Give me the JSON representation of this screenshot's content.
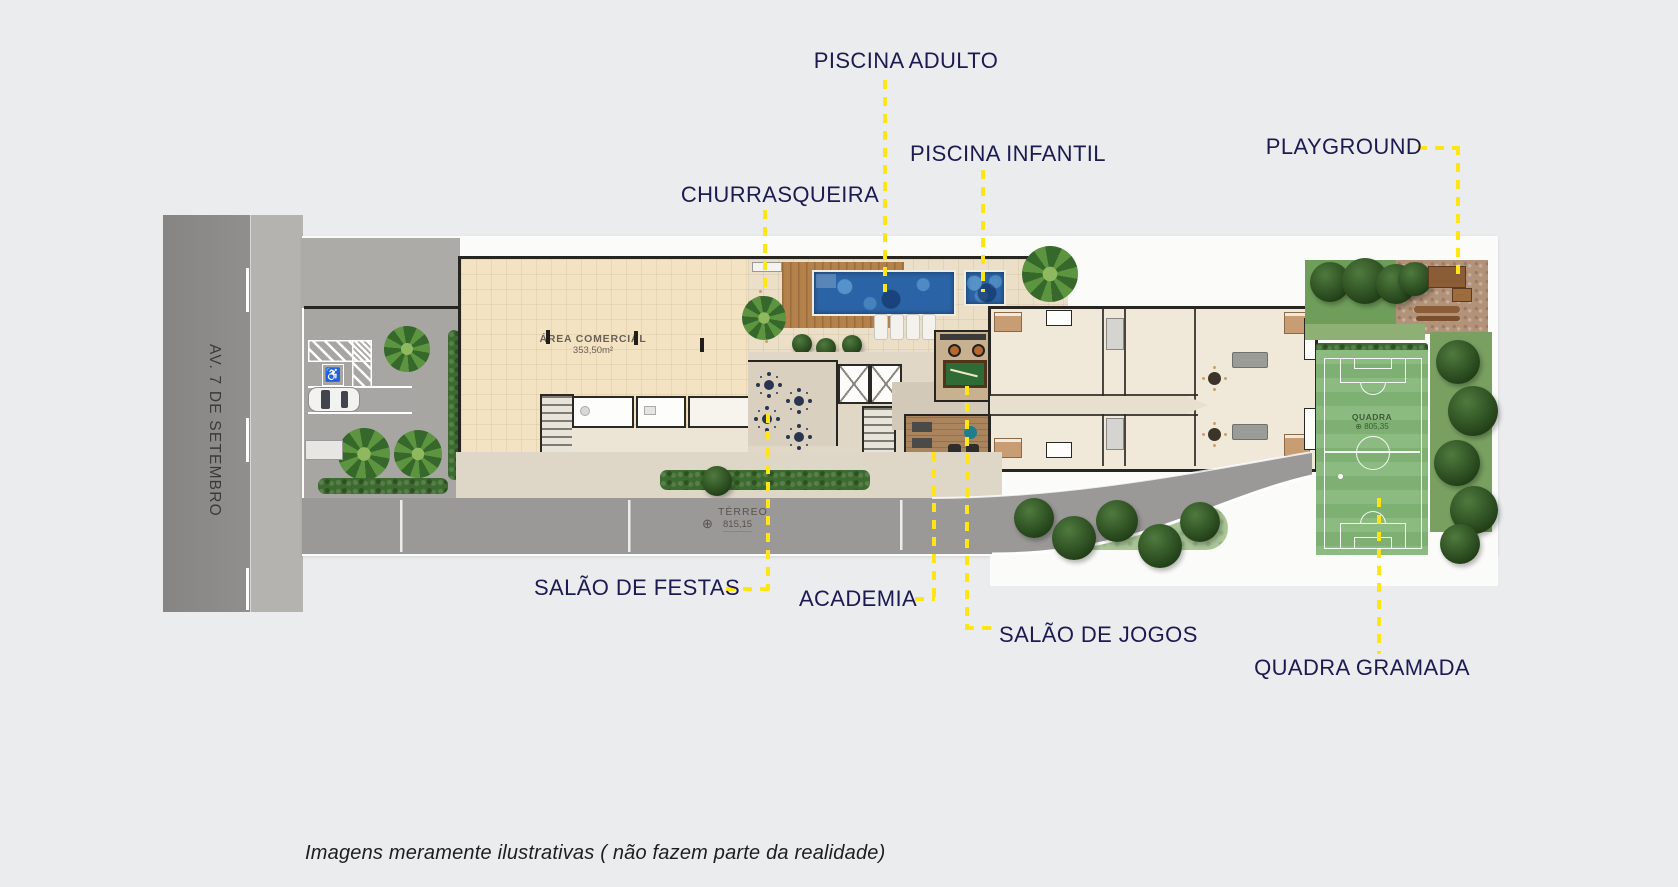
{
  "colors": {
    "bg": "#ebecee",
    "label": "#1b1b52",
    "yellow": "#ffe416",
    "road": "#8d8b89",
    "sidewalk": "#b5b3b0",
    "plate": "#fbfbf9",
    "drive": "#9b9997",
    "beige_floor": "#f3e3c3",
    "terrace": "#ebdfc8",
    "deck": "#b5814b",
    "pool": "#2b64a6",
    "field": "#85b779",
    "hedge": "#3d6b2f",
    "sand": "#b2937a",
    "apt": "#f0e8d8",
    "wall": "#26251f",
    "wood": "#aa845c"
  },
  "street": {
    "name": "AV. 7 DE SETEMBRO"
  },
  "callouts": {
    "piscina_adulto": "PISCINA ADULTO",
    "piscina_infantil": "PISCINA INFANTIL",
    "churrasqueira": "CHURRASQUEIRA",
    "playground": "PLAYGROUND",
    "salao_de_festas": "SALÃO DE FESTAS",
    "academia": "ACADEMIA",
    "salao_de_jogos": "SALÃO DE JOGOS",
    "quadra_gramada": "QUADRA GRAMADA"
  },
  "plan_annotations": {
    "area_comercial": {
      "title": "ÁREA COMERCIAL",
      "area": "353,50m²"
    },
    "terreo": {
      "label": "TÉRREO",
      "level": "815,15"
    },
    "quadra": {
      "label": "QUADRA",
      "level": "805,35"
    }
  },
  "icons": {
    "wheelchair": "♿",
    "level_marker": "⊕"
  },
  "disclaimer": "Imagens meramente ilustrativas ( não fazem parte da realidade)"
}
